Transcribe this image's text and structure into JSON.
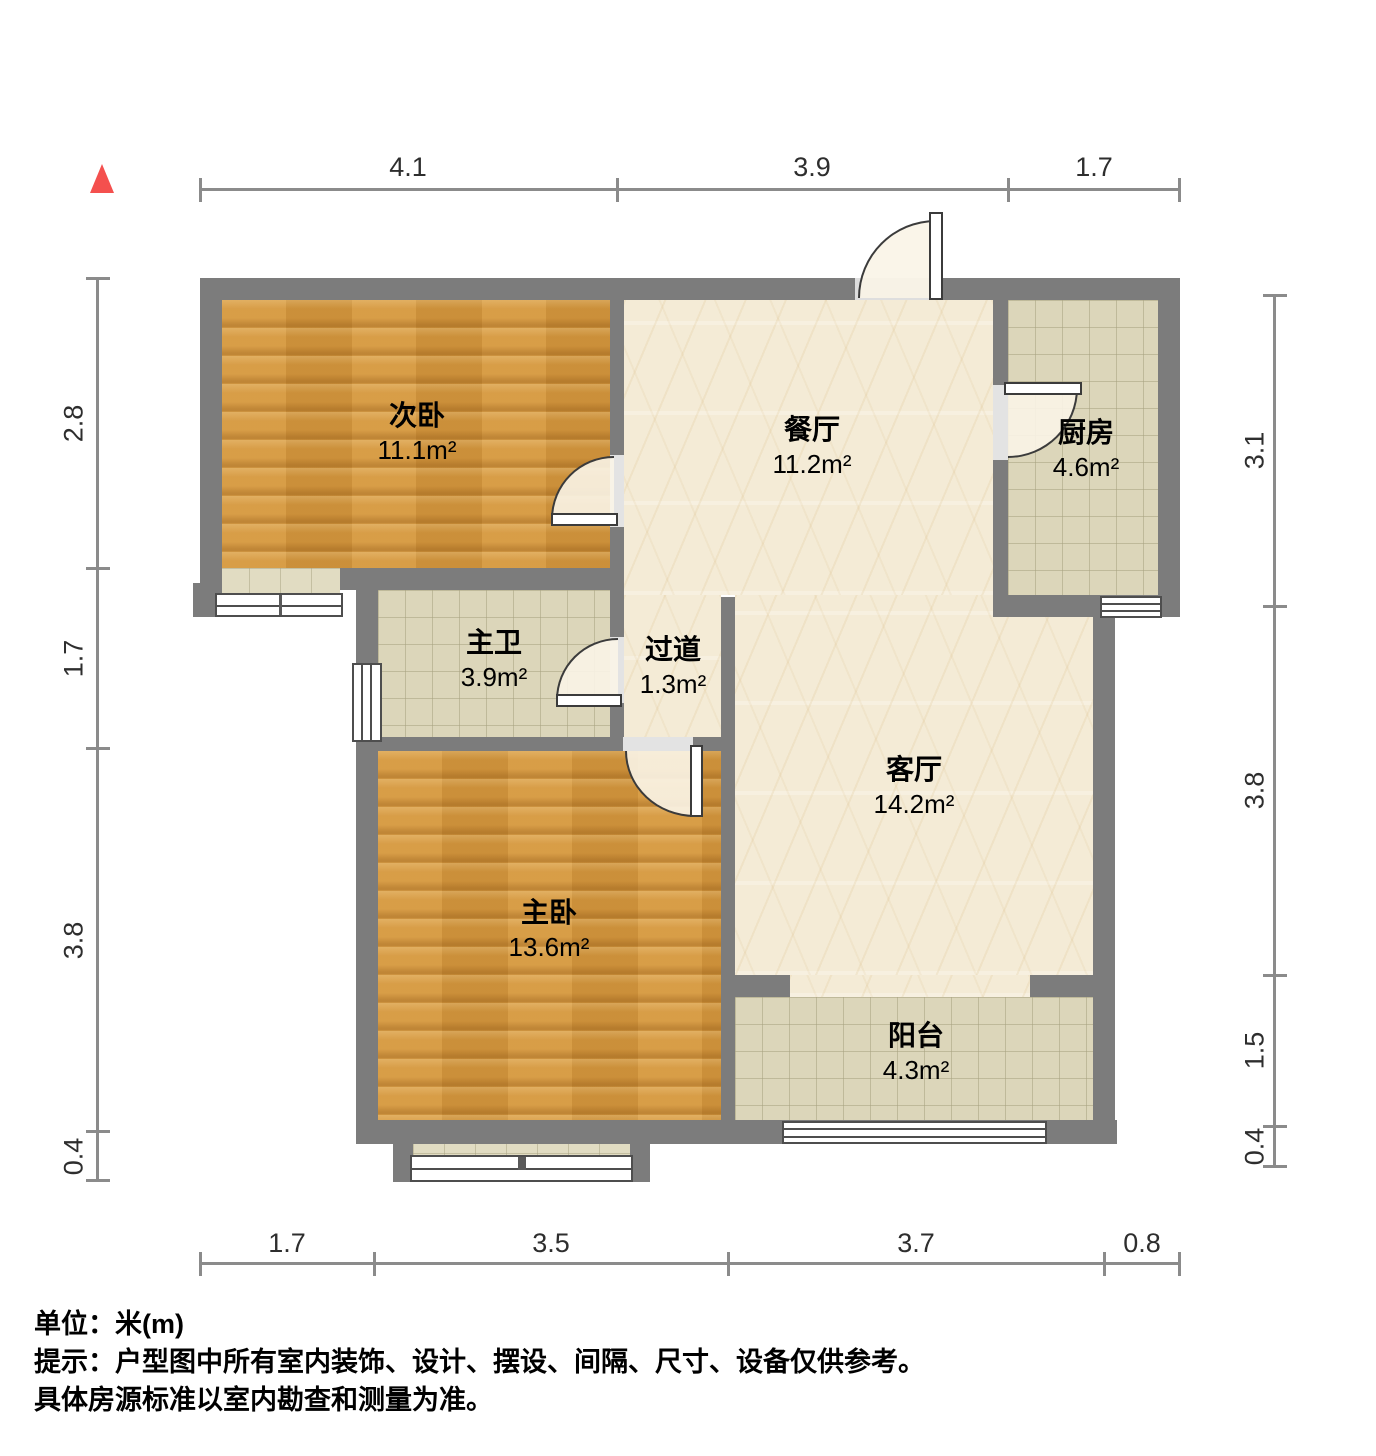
{
  "plan": {
    "rooms": [
      {
        "name": "次卧",
        "area": "11.1m²"
      },
      {
        "name": "餐厅",
        "area": "11.2m²"
      },
      {
        "name": "厨房",
        "area": "4.6m²"
      },
      {
        "name": "主卫",
        "area": "3.9m²"
      },
      {
        "name": "过道",
        "area": "1.3m²"
      },
      {
        "name": "客厅",
        "area": "14.2m²"
      },
      {
        "name": "主卧",
        "area": "13.6m²"
      },
      {
        "name": "阳台",
        "area": "4.3m²"
      }
    ],
    "dimensions_m": {
      "top": [
        "4.1",
        "3.9",
        "1.7"
      ],
      "bottom": [
        "1.7",
        "3.5",
        "3.7",
        "0.8"
      ],
      "left": [
        "2.8",
        "1.7",
        "3.8",
        "0.4"
      ],
      "right": [
        "3.1",
        "3.8",
        "1.5",
        "0.4"
      ]
    }
  },
  "footer": {
    "line1": "单位：米(m)",
    "line2": "提示：户型图中所有室内装饰、设计、摆设、间隔、尺寸、设备仅供参考。",
    "line3": "具体房源标准以室内勘查和测量为准。"
  },
  "colors": {
    "wall": "#7c7c7c",
    "wood_floor": "#d4973e",
    "marble_floor": "#f4ebd6",
    "tile_floor": "#dcd6ba",
    "north_arrow": "#f4504e",
    "dimension_line": "#8b8b8b"
  }
}
